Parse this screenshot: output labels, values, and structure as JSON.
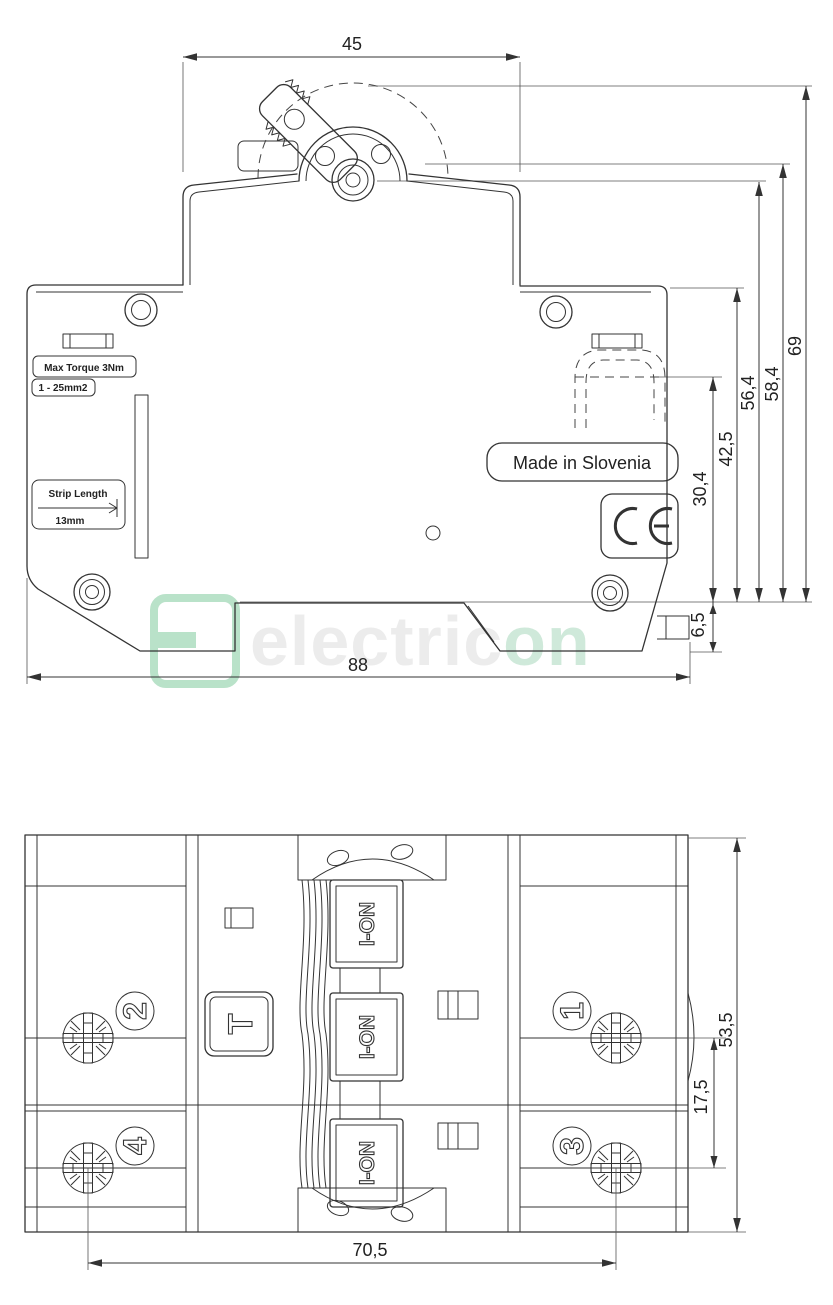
{
  "meta": {
    "background": "#ffffff",
    "line_color": "#333333",
    "watermark_green": "#b9e2c9",
    "watermark_gray": "#ececec"
  },
  "watermark": {
    "brand_prefix": "electric",
    "brand_suffix": "on"
  },
  "side_view": {
    "labels": {
      "max_torque": "Max Torque 3Nm",
      "wire_range": "1 - 25mm2",
      "strip_length_title": "Strip Length",
      "strip_length_value": "13mm",
      "made_in": "Made in Slovenia"
    },
    "icons": [
      "ce-mark-icon",
      "din-clip",
      "toggle-lever",
      "mounting-holes"
    ],
    "dims": {
      "module_width": "45",
      "overall_height": "69",
      "lever_height": "58,4",
      "pivot_height": "56,4",
      "body_height": "42,5",
      "terminal_height": "30,4",
      "clip_depth": "6,5",
      "body_width": "88"
    }
  },
  "front_view": {
    "dims": {
      "device_height": "53,5",
      "row_offset": "17,5",
      "screw_spacing": "70,5"
    },
    "poles": {
      "p1": "1",
      "p2": "2",
      "p3": "3",
      "p4": "4"
    },
    "switch_label": "I-ON",
    "test_button_label": "T"
  }
}
